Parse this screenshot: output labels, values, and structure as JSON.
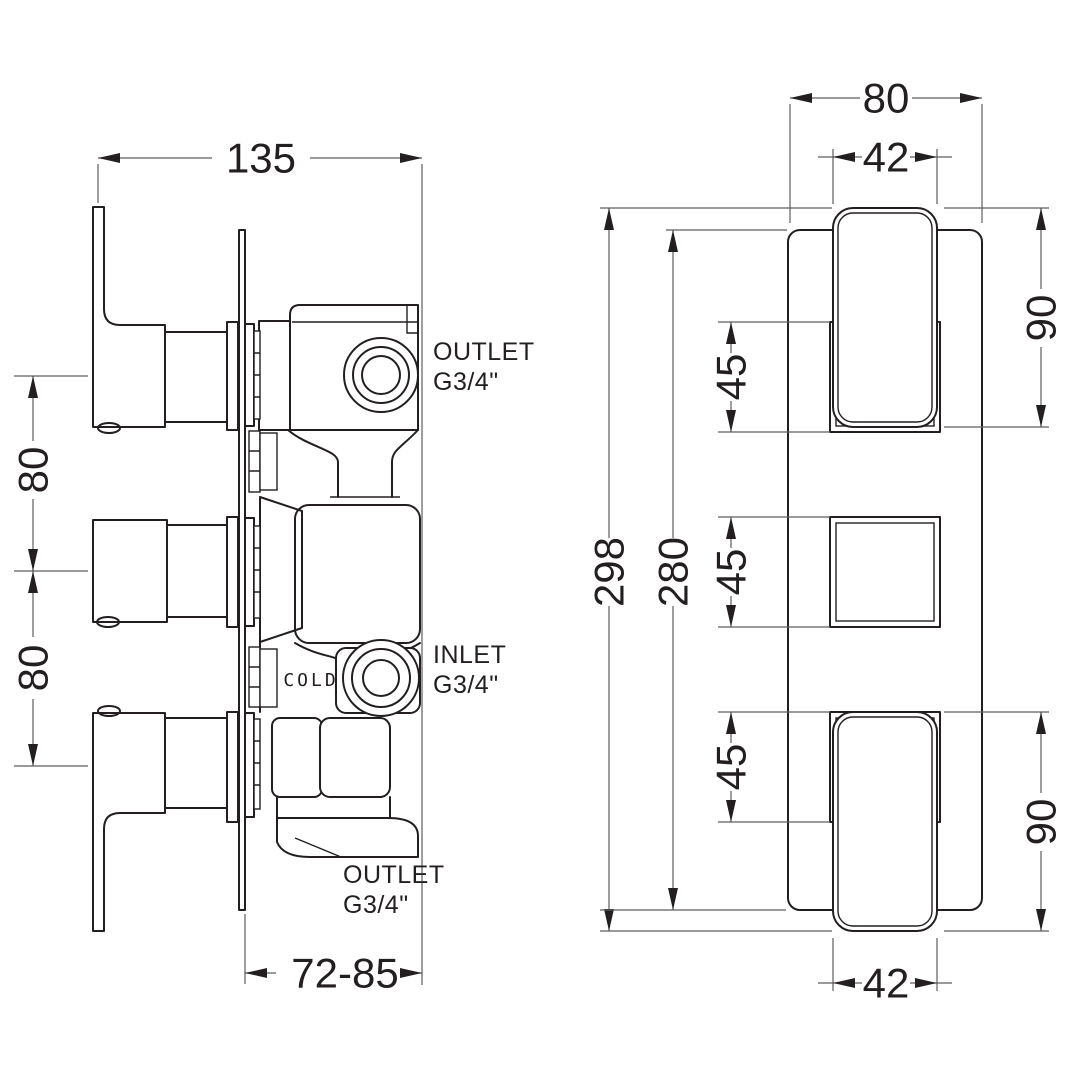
{
  "colors": {
    "line": "#231f20",
    "dim": "#5e5e5e",
    "background": "#ffffff"
  },
  "side_view": {
    "dim_width": "135",
    "dim_handle_spacing_upper": "80",
    "dim_handle_spacing_lower": "80",
    "dim_install_depth": "72-85",
    "label_outlet_top_line1": "OUTLET",
    "label_outlet_top_line2": "G3/4\"",
    "label_inlet_line1": "INLET",
    "label_inlet_line2": "G3/4\"",
    "label_outlet_bottom_line1": "OUTLET",
    "label_outlet_bottom_line2": "G3/4\"",
    "label_cold": "COLD"
  },
  "front_view": {
    "dim_plate_width": "80",
    "dim_handle_width_top": "42",
    "dim_handle_height_top": "90",
    "dim_overall_height": "298",
    "dim_plate_height": "280",
    "dim_square_top": "45",
    "dim_square_mid": "45",
    "dim_square_bottom": "45",
    "dim_handle_height_bottom": "90",
    "dim_handle_width_bottom": "42"
  }
}
